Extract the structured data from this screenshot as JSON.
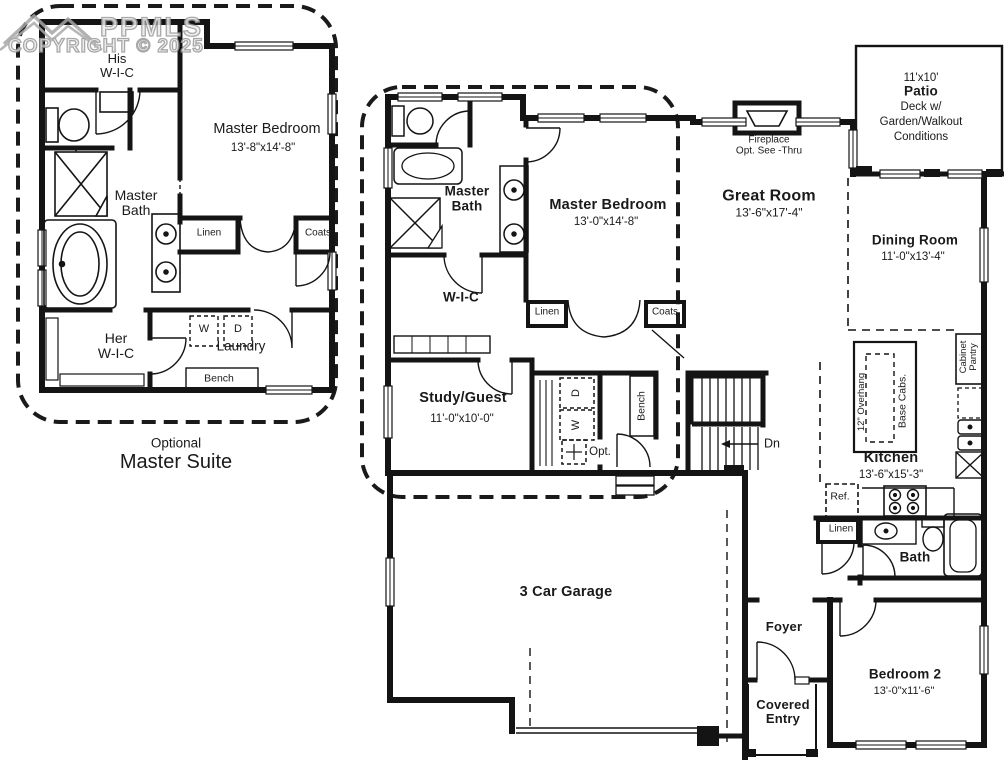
{
  "watermark": {
    "brand": "PPMLS",
    "copyright": "COPYRIGHT © 2025"
  },
  "optional_suite": {
    "caption_small": "Optional",
    "caption_large": "Master Suite",
    "his_wic_1": "His",
    "his_wic_2": "W-I-C",
    "master_bedroom": "Master Bedroom",
    "master_bedroom_dims": "13'-8\"x14'-8\"",
    "master_bath_1": "Master",
    "master_bath_2": "Bath",
    "linen": "Linen",
    "coats": "Coats",
    "her_wic_1": "Her",
    "her_wic_2": "W-I-C",
    "laundry": "Laundry",
    "washer": "W",
    "dryer": "D",
    "bench": "Bench"
  },
  "main_plan": {
    "master_bath_1": "Master",
    "master_bath_2": "Bath",
    "master_bedroom": "Master Bedroom",
    "master_bedroom_dims": "13'-0\"x14'-8\"",
    "fireplace_1": "Fireplace",
    "fireplace_2": "Opt. See -Thru",
    "great_room": "Great Room",
    "great_room_dims": "13'-6\"x17'-4\"",
    "patio_size": "11'x10'",
    "patio": "Patio",
    "patio_note_1": "Deck w/",
    "patio_note_2": "Garden/Walkout",
    "patio_note_3": "Conditions",
    "dining_room": "Dining Room",
    "dining_room_dims": "11'-0\"x13'-4\"",
    "wic": "W-I-C",
    "linen": "Linen",
    "coats": "Coats",
    "study_guest": "Study/Guest",
    "study_guest_dims": "11'-0\"x10'-0\"",
    "washer": "W",
    "dryer": "D",
    "opt": "Opt.",
    "bench": "Bench",
    "stairs_down": "Dn",
    "kitchen": "Kitchen",
    "kitchen_dims": "13'-6\"x15'-3\"",
    "overhang": "12\" Overhang",
    "base_cabs": "Base Cabs.",
    "cabinet_pantry_1": "Cabinet",
    "cabinet_pantry_2": "Pantry",
    "ref": "Ref.",
    "linen2": "Linen",
    "bath": "Bath",
    "garage": "3 Car Garage",
    "foyer": "Foyer",
    "covered_entry_1": "Covered",
    "covered_entry_2": "Entry",
    "bedroom2": "Bedroom 2",
    "bedroom2_dims": "13'-0\"x11'-6\""
  },
  "colors": {
    "wall": "#141414",
    "watermark": "#9a9a9a",
    "background": "#ffffff"
  }
}
